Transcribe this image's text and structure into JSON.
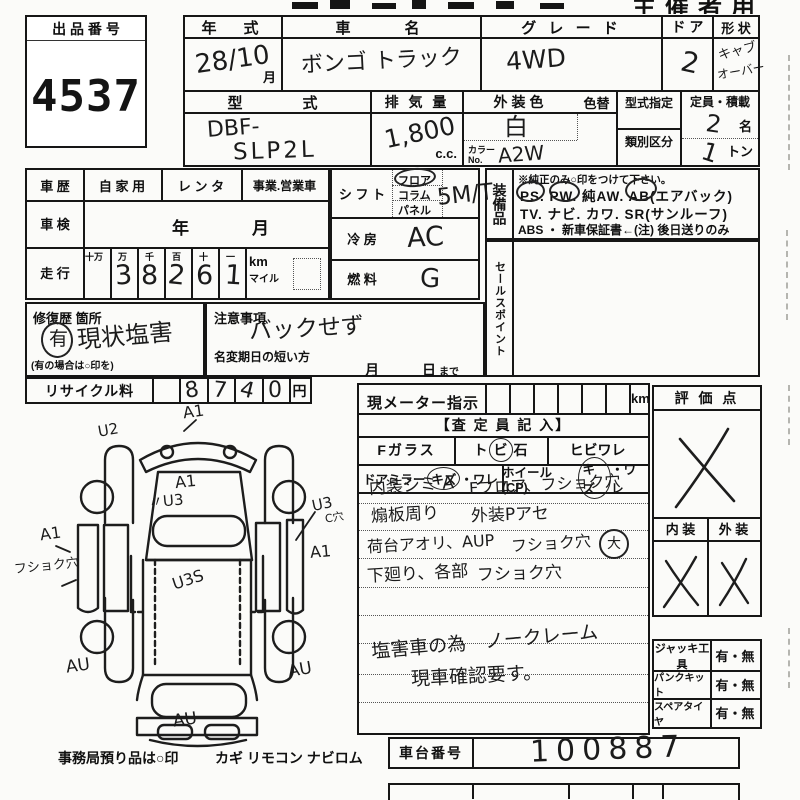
{
  "meta": {
    "organizer_label": "主催者用"
  },
  "lot": {
    "header": "出 品 番 号",
    "number": "4537"
  },
  "vehicle": {
    "year_label": "年　式",
    "year_value": "28/10",
    "year_suffix": "月",
    "name_label": "車　　名",
    "name_value": "ボンゴ トラック",
    "grade_label": "グ レ ー ド",
    "grade_value": "4WD",
    "door_label": "ド ア",
    "door_value": "2",
    "shape_label": "形 状",
    "shape_value_1": "キャブ",
    "shape_value_2": "オーバー",
    "model_label": "型　　式",
    "model_value_1": "DBF-",
    "model_value_2": "SLP2L",
    "displacement_label": "排 気 量",
    "displacement_value": "1,800",
    "displacement_unit": "c.c.",
    "color_label": "外装色",
    "color_value": "白",
    "color_change_label": "色替",
    "color_no_label": "カラーNo.",
    "color_no_value": "A2W",
    "type_designation_label": "型式指定",
    "class_label": "類別区分",
    "capacity_label": "定員・積載",
    "capacity_persons_value": "2",
    "capacity_persons_unit": "名",
    "capacity_load_value": "1",
    "capacity_load_unit": "トン"
  },
  "history": {
    "label": "車 歴",
    "opt1": "自 家 用",
    "opt2": "レ ン タ",
    "opt3": "事業.営業車"
  },
  "inspection": {
    "label": "車 検",
    "year": "年",
    "month": "月"
  },
  "mileage": {
    "label": "走 行",
    "headers": [
      "十万",
      "万",
      "千",
      "百",
      "十",
      "一"
    ],
    "digits": [
      "",
      "3",
      "8",
      "2",
      "6",
      "1"
    ],
    "unit_km": "km",
    "unit_mile": "マイル"
  },
  "shift": {
    "label": "シ フ ト",
    "opt1": "フロア",
    "opt2": "コラム",
    "opt3": "パネル",
    "circled_option": "フロア",
    "value": "5M/T"
  },
  "cooling": {
    "label": "冷 房",
    "value": "AC"
  },
  "fuel": {
    "label": "燃 料",
    "value": "G"
  },
  "equipment": {
    "label": "装備品",
    "note": "※純正のみ○印をつけて下さい。",
    "line1": "PS.  PW.  純AW.  AB(エアバック)",
    "line2": "TV.  ナビ.  カワ.  SR(サンルーフ)",
    "line3": "ABS ・ 新車保証書←(注) 後日送りのみ",
    "circled": [
      "PS",
      "PW",
      "AB"
    ]
  },
  "sales_point": {
    "label": "セールスポイント"
  },
  "repair": {
    "label": "修復歴 箇所",
    "marked": "有",
    "value": "現状塩害",
    "note": "(有の場合は○印を)"
  },
  "caution": {
    "label": "注意事項",
    "value": "バックせず",
    "name_change_label": "名変期日の短い方",
    "month": "月",
    "day": "日",
    "until": "まで"
  },
  "recycle": {
    "label": "リサイクル料",
    "digits": [
      "",
      "8",
      "7",
      "4",
      "0"
    ],
    "unit": "円"
  },
  "diagram": {
    "marks": {
      "top": "A1",
      "top_left": "U2",
      "cab": "A1",
      "cab_lower": "〃U3",
      "right_upper": "U3",
      "right_upper_sub": "C穴",
      "left_upper": "A1",
      "left_note": "フショク穴",
      "right_mid": "A1",
      "bed": "U3S",
      "bottom_left": "AU",
      "bottom_right": "AU",
      "bottom_center": "AU"
    }
  },
  "deposit_note": {
    "label": "事務局預り品は○印",
    "items": "カギ  リモコン  ナビロム"
  },
  "meter": {
    "label": "現メーター指示",
    "unit": "km"
  },
  "assessor": {
    "header": "【査 定 員 記 入】",
    "glass_label": "Fガラス",
    "stone_pre": "ト",
    "stone_circled": "ビ",
    "stone_post": "石",
    "crack_label": "ヒビワレ",
    "mirror_label": "ドアミラー",
    "mirror_circled": "キズ",
    "mirror_rest": "・ワレ",
    "wheel_label": "ホイール(CP)",
    "wheel_circled": "キズ",
    "wheel_rest": "・ワレ",
    "notes": [
      {
        "left": "内装シミ A",
        "right": "Fフロア、フショク穴"
      },
      {
        "left": "煽板周り",
        "right": "外装Pアセ"
      },
      {
        "left": "荷台アオリ、AUP",
        "right": "フショク穴",
        "circled": "大"
      },
      {
        "left": "下廻り、各部",
        "right": "フショク穴"
      }
    ],
    "remark1": "塩害車の為　ノークレーム",
    "remark2": "現車確認要す。"
  },
  "evaluation": {
    "header": "評 価 点",
    "score_mark": "×",
    "interior_label": "内 装",
    "exterior_label": "外 装",
    "interior_mark": "×",
    "exterior_mark": "×"
  },
  "tools": {
    "rows": [
      {
        "label": "ジャッキ工具",
        "value": "有・無"
      },
      {
        "label": "パンクキット",
        "value": "有・無"
      },
      {
        "label": "スペアタイヤ",
        "value": "有・無"
      }
    ]
  },
  "chassis": {
    "label": "車台番号",
    "value": "100887"
  }
}
